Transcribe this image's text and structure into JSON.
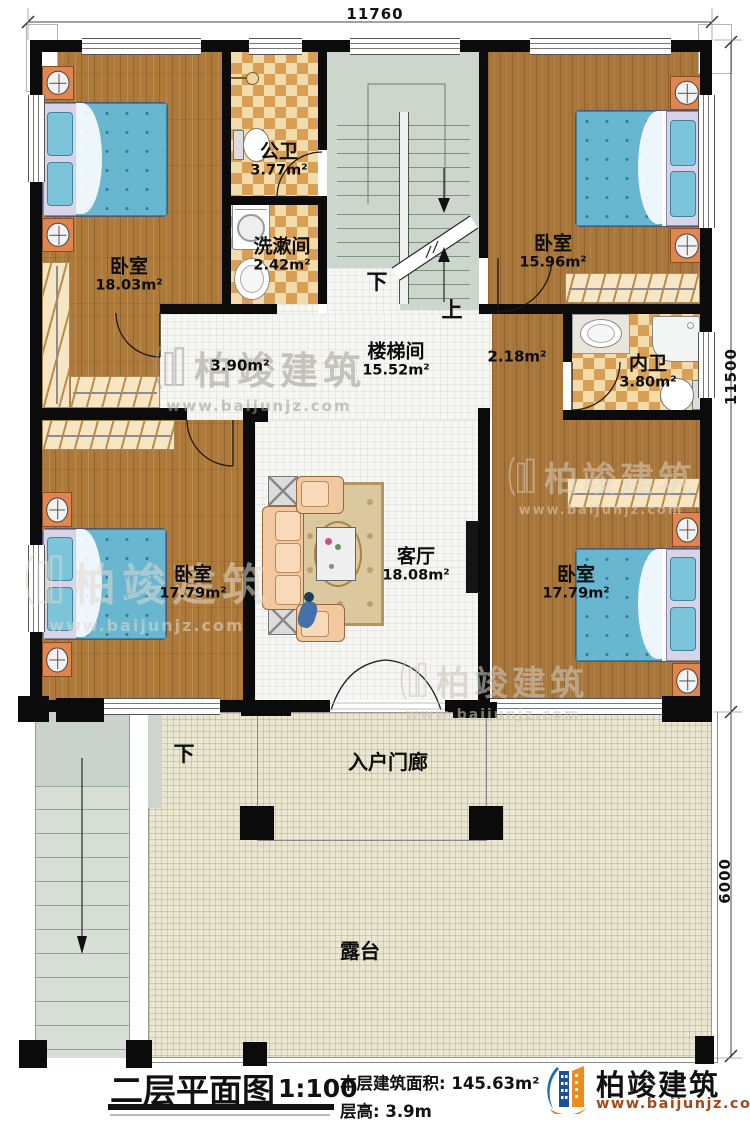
{
  "dimensions": {
    "top": "11760",
    "right_upper": "11500",
    "right_lower": "6000"
  },
  "rooms": {
    "bedroom_tl": {
      "name": "卧室",
      "area": "18.03m²"
    },
    "public_bath": {
      "name": "公卫",
      "area": "3.77m²"
    },
    "washroom": {
      "name": "洗漱间",
      "area": "2.42m²"
    },
    "stairwell": {
      "name": "楼梯间",
      "area": "15.52m²"
    },
    "hall_left": {
      "area": "3.90m²"
    },
    "hall_right": {
      "area": "2.18m²"
    },
    "bedroom_tr": {
      "name": "卧室",
      "area": "15.96m²"
    },
    "ensuite": {
      "name": "内卫",
      "area": "3.80m²"
    },
    "bedroom_bl": {
      "name": "卧室",
      "area": "17.79m²"
    },
    "living": {
      "name": "客厅",
      "area": "18.08m²"
    },
    "bedroom_br": {
      "name": "卧室",
      "area": "17.79m²"
    },
    "porch": {
      "name": "入户门廊"
    },
    "terrace": {
      "name": "露台"
    }
  },
  "stairs": {
    "down_label": "下",
    "up_label": "上",
    "porch_down_label": "下"
  },
  "title_block": {
    "title": "二层平面图",
    "scale": "1:100",
    "area_label": "本层建筑面积:",
    "area_value": "145.63m²",
    "floor_height_label": "层高:",
    "floor_height_value": "3.9m"
  },
  "logo": {
    "company": "柏竣建筑",
    "website": "www.baijunjz.com"
  },
  "watermark": {
    "company": "柏竣建筑",
    "website": "www.baijunjz.com"
  },
  "colors": {
    "wall": "#0b0b0b",
    "wood": "#ad7a3b",
    "bed": "#68b6d0",
    "logo_blue": "#1f6cb4",
    "logo_orange": "#f08a1e",
    "url_brown": "#a6481c"
  }
}
